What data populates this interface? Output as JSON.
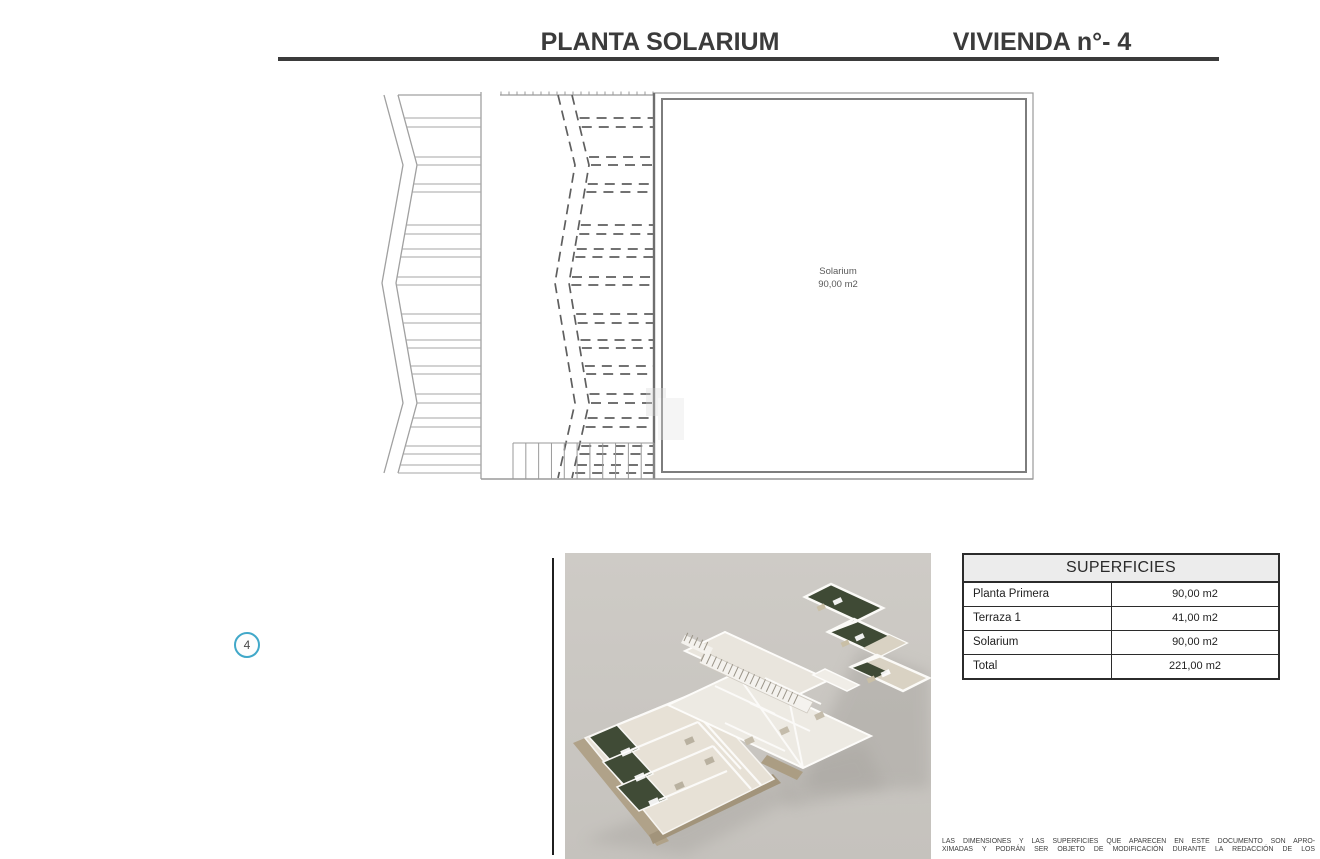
{
  "header": {
    "title_left": "PLANTA SOLARIUM",
    "title_right": "VIVIENDA n°- 4",
    "rule_color": "#3b3b3b"
  },
  "plan": {
    "room_label": "Solarium",
    "room_area": "90,00 m2",
    "line_color": "#9a9a9a",
    "dash_color": "#5f5f5f"
  },
  "marker": {
    "number": "4",
    "circle_color": "#41a8c9"
  },
  "render3d": {
    "background": "#cac7c2",
    "wall_color": "#f4f2ee",
    "floor_color": "#e7e1d6",
    "garden_color": "#3f4a35",
    "stone_color": "#b0a289"
  },
  "table": {
    "title": "SUPERFICIES",
    "rows": [
      {
        "label": "Planta Primera",
        "value": "90,00 m2"
      },
      {
        "label": "Terraza 1",
        "value": "41,00 m2"
      },
      {
        "label": "Solarium",
        "value": "90,00 m2"
      },
      {
        "label": "Total",
        "value": "221,00 m2"
      }
    ]
  },
  "disclaimer": {
    "line1": "LAS DIMENSIONES Y LAS SUPERFICIES QUE APARECEN EN ESTE DOCUMENTO SON APRO-",
    "line2": "XIMADAS Y PODRÁN SER OBJETO DE MODIFICACIÓN DURANTE LA REDACCIÓN DE LOS"
  }
}
